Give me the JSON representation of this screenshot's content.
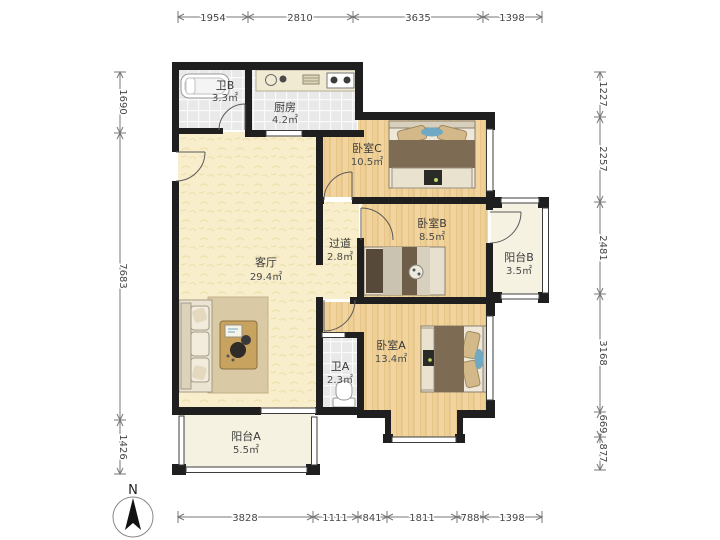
{
  "title": "apartment-floorplan",
  "north_label": "N",
  "rooms": [
    {
      "id": "bath-b",
      "name": "卫B",
      "area": "3.3㎡"
    },
    {
      "id": "kitchen",
      "name": "厨房",
      "area": "4.2㎡"
    },
    {
      "id": "bedroom-c",
      "name": "卧室C",
      "area": "10.5㎡"
    },
    {
      "id": "hallway",
      "name": "过道",
      "area": "2.8㎡"
    },
    {
      "id": "bedroom-b",
      "name": "卧室B",
      "area": "8.5㎡"
    },
    {
      "id": "balcony-b",
      "name": "阳台B",
      "area": "3.5㎡"
    },
    {
      "id": "living",
      "name": "客厅",
      "area": "29.4㎡"
    },
    {
      "id": "bath-a",
      "name": "卫A",
      "area": "2.3㎡"
    },
    {
      "id": "bedroom-a",
      "name": "卧室A",
      "area": "13.4㎡"
    },
    {
      "id": "balcony-a",
      "name": "阳台A",
      "area": "5.5㎡"
    }
  ],
  "dimensions": {
    "top": [
      "1954",
      "2810",
      "3635",
      "1398"
    ],
    "bottom": [
      "3828",
      "1111",
      "841",
      "1811",
      "788",
      "1398"
    ],
    "left": [
      "1690",
      "7683",
      "1426"
    ],
    "right": [
      "1227",
      "2257",
      "2481",
      "3168",
      "669",
      "877"
    ]
  },
  "colors": {
    "wall": "#1f1f1f",
    "wood_floor": "#f1d49e",
    "tile_floor": "#e9e9e9",
    "living_floor": "#f8eecb",
    "balcony_floor": "#f6f2e2",
    "blanket_brown": "#7d6b54",
    "accent_blue": "#6fa9c4",
    "rug_tan": "#d9c9a4"
  }
}
